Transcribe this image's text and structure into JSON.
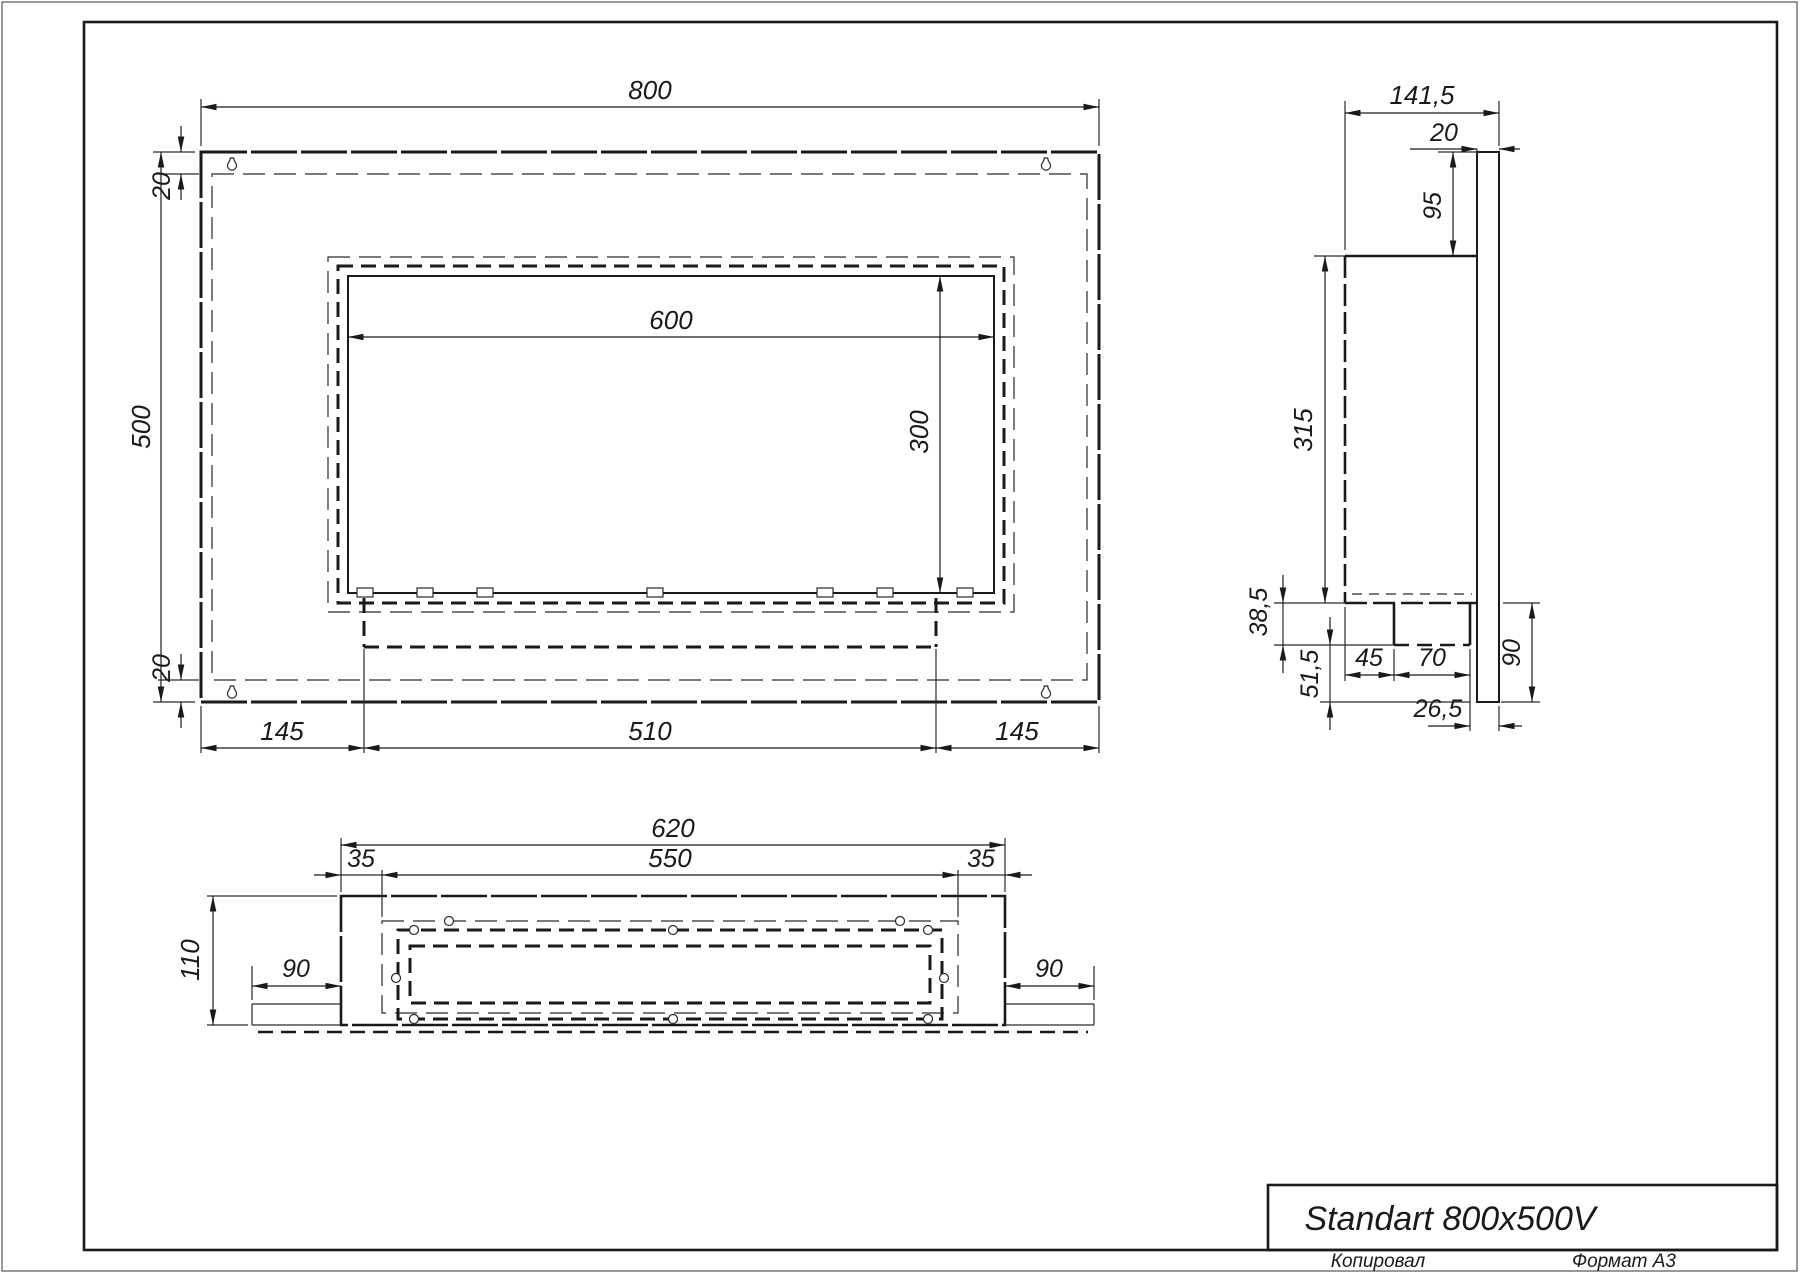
{
  "title_block": {
    "model": "Standart 800x500V",
    "copied": "Копировал",
    "format": "Формат A3"
  },
  "front_view": {
    "dims": {
      "overall_width": "800",
      "overall_height": "500",
      "top_inset": "20",
      "bottom_inset": "20",
      "opening_width": "600",
      "opening_height": "300",
      "left_margin": "145",
      "burner_width": "510",
      "right_margin": "145"
    }
  },
  "side_view": {
    "dims": {
      "overall_depth": "141,5",
      "panel_thickness": "20",
      "top_offset": "95",
      "body_height": "315",
      "lip_drop": "38,5",
      "bottom_gap": "51,5",
      "burner_setback": "45",
      "burner_depth": "70",
      "rear_gap": "26,5",
      "panel_below": "90"
    }
  },
  "bottom_view": {
    "dims": {
      "overall_width": "620",
      "inner_width": "550",
      "left_inset": "35",
      "right_inset": "35",
      "depth": "110",
      "left_flange": "90",
      "right_flange": "90"
    }
  }
}
